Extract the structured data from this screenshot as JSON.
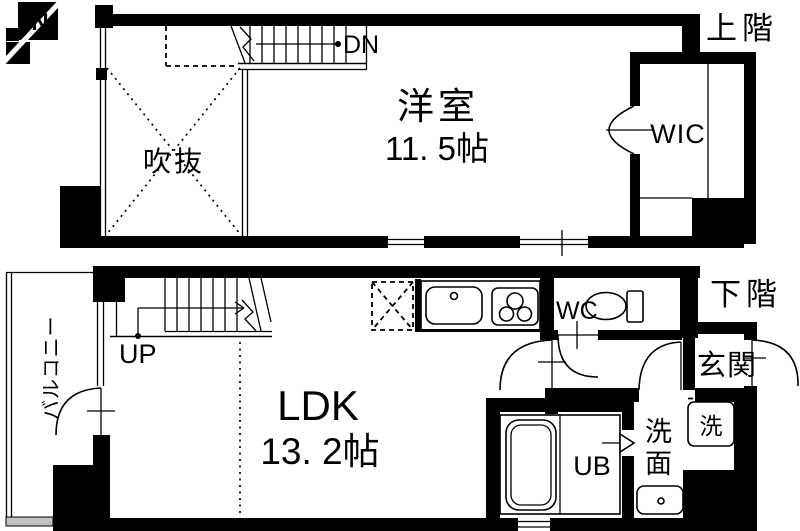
{
  "page": {
    "background_color": "#ffffff",
    "wall_color": "#000000",
    "line_color": "#000000",
    "balcony_edge_color": "#c2c2c2"
  },
  "compass": {
    "label": "N"
  },
  "upper_floor": {
    "floor_label": "上階",
    "stair_label": "DN",
    "rooms": {
      "bedroom": {
        "name": "洋室",
        "size": "11. 5帖"
      },
      "void": {
        "name": "吹抜"
      },
      "wic": {
        "name": "WIC"
      }
    }
  },
  "lower_floor": {
    "floor_label": "下階",
    "stair_label": "UP",
    "rooms": {
      "ldk": {
        "name": "LDK",
        "size": "13. 2帖"
      },
      "balcony": {
        "name": "バルコニー"
      },
      "wc": {
        "name": "WC"
      },
      "entrance": {
        "name": "玄関"
      },
      "washroom": {
        "name": "洗面",
        "line1": "洗",
        "line2": "面"
      },
      "washer": {
        "name": "洗"
      },
      "bath": {
        "name": "UB"
      }
    }
  }
}
